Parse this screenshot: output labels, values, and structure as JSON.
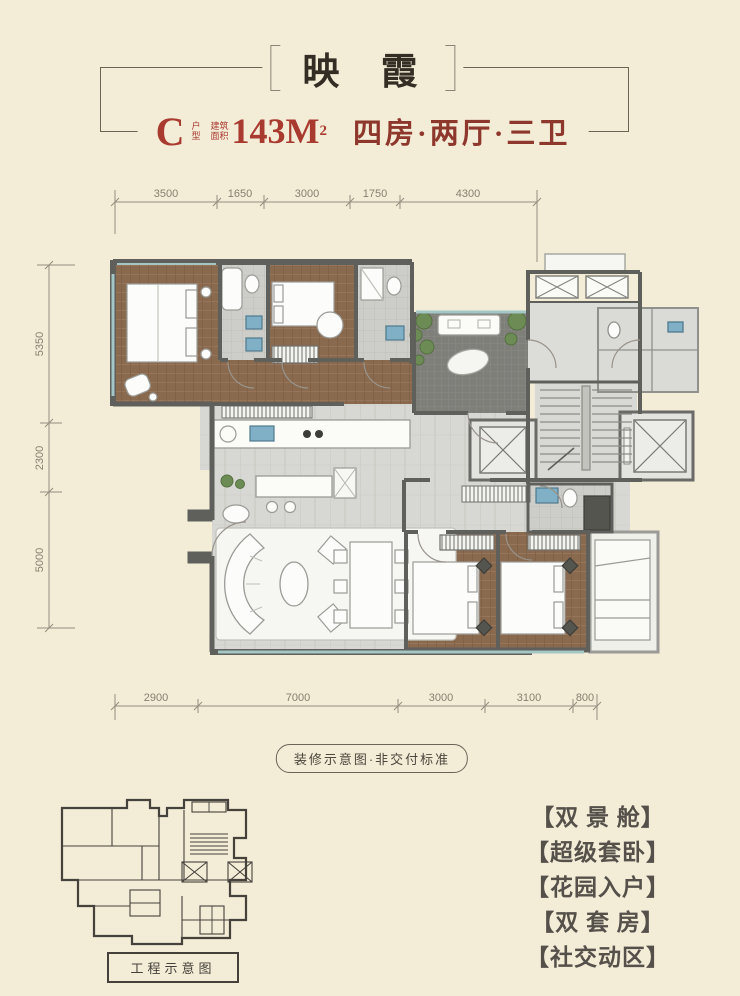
{
  "header": {
    "title": "映 霞",
    "unit": "C",
    "unit_small_top": "户",
    "unit_small_bottom": "型",
    "area_small_1": "建筑",
    "area_small_2": "面积",
    "area": "143M",
    "area_sup": "2",
    "rooms": "四房·两厅·三卫"
  },
  "dimensions": {
    "top": [
      "3500",
      "1650",
      "3000",
      "1750",
      "4300"
    ],
    "left": [
      "5350",
      "2300",
      "5000"
    ],
    "bottom": [
      "2900",
      "7000",
      "3000",
      "3100",
      "800"
    ]
  },
  "notes": {
    "plan_disclaimer": "装修示意图·非交付标准",
    "engineering_caption": "工程示意图"
  },
  "features": [
    "【双 景 舱】",
    "【超级套卧】",
    "【花园入户】",
    "【双 套 房】",
    "【社交动区】"
  ],
  "colors": {
    "background": "#f3ecd7",
    "accent_red": "#a93a30",
    "rooms_red": "#8e372c",
    "title_dark": "#332d24",
    "wall_gray": "#5f5f5c",
    "wood_floor": "#8a6a4e",
    "tile_gray": "#d6d6d2",
    "window_teal": "#a4c6c4",
    "plant_green": "#6d8c55",
    "garden_paving": "#7f7f7a"
  }
}
